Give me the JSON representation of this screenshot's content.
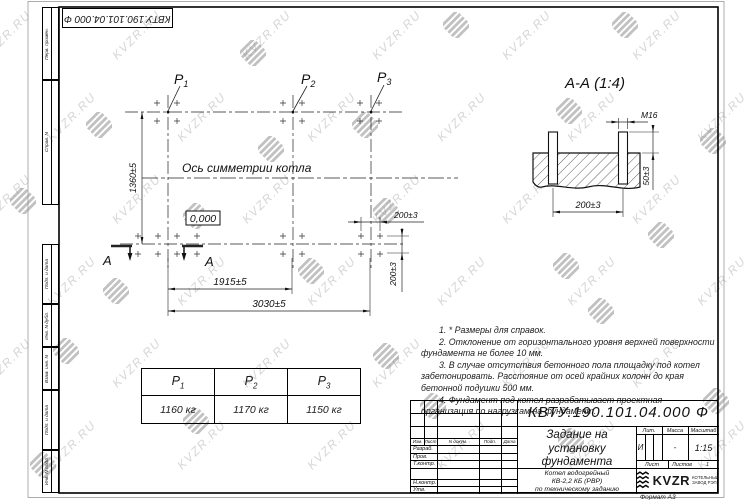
{
  "sheet": {
    "format_label": "Формат А3",
    "top_stamp": "КВТУ.190.101.04.000  Ф",
    "margin_labels": [
      "Перв. примен.",
      "Справ. N",
      "Подп. и дата",
      "Инв. N дубл.",
      "Взам. инв. N",
      "Подп. и дата",
      "Инв. N подл."
    ]
  },
  "watermark": {
    "text": "KVZR.RU"
  },
  "plan": {
    "axis_label": "Ось симметрии котла",
    "elevation": "0,000",
    "section_letter": "А",
    "points": [
      {
        "base": "P",
        "sub": "1"
      },
      {
        "base": "P",
        "sub": "2"
      },
      {
        "base": "P",
        "sub": "3"
      }
    ],
    "dims": {
      "height": "1360±5",
      "span_p1_p2": "1915±5",
      "span_total": "3030±5",
      "bolt_spacing_h": "200±3",
      "bolt_spacing_v": "200±3"
    }
  },
  "section_view": {
    "title": "А-А  (1:4)",
    "dims": {
      "thread": "М16",
      "protrusion": "50±3",
      "spacing": "200±3"
    }
  },
  "notes": [
    "1.  * Размеры для справок.",
    "2.  Отклонение от горизонтального уровня верхней поверхности фундамента не более 10 мм.",
    "3.  В случае отсутствия бетонного пола площадку под котел забетонировать. Расстояние от осей крайних колонн до края бетонной подушки 500 мм.",
    "4.  Фундамент под котел разрабатывает проектная организация по нагрузкам на фундамент."
  ],
  "load_table": {
    "headers": [
      {
        "base": "P",
        "sub": "1"
      },
      {
        "base": "P",
        "sub": "2"
      },
      {
        "base": "P",
        "sub": "3"
      }
    ],
    "values": [
      "1160  кг",
      "1170  кг",
      "1150  кг"
    ]
  },
  "title_block": {
    "doc_number": "КВТУ.190.101.04.000  Ф",
    "title_lines": [
      "Задание на",
      "установку",
      "фундамента"
    ],
    "product_lines": [
      "Котел водогрейный",
      "КВ-2,2 КБ (РВР)",
      "по техническому заданию"
    ],
    "rev_headers": [
      "Изм.",
      "Лист",
      "N докум.",
      "Подп.",
      "Дата"
    ],
    "sig_labels": [
      "Разраб.",
      "Пров.",
      "Т.контр.",
      "",
      "Н.контр.",
      "Утв."
    ],
    "lit_header": "Лит.",
    "mass_header": "Масса",
    "scale_header": "Масштаб",
    "lit_value": "И",
    "mass_value": "-",
    "scale_value": "1:15",
    "sheet_label": "Лист",
    "sheets_label": "Листов",
    "sheets_value": "1",
    "logo_text": "KVZR",
    "logo_caption": [
      "КОТЕЛЬНЫЙ",
      "ЗАВОД РЭП"
    ]
  }
}
